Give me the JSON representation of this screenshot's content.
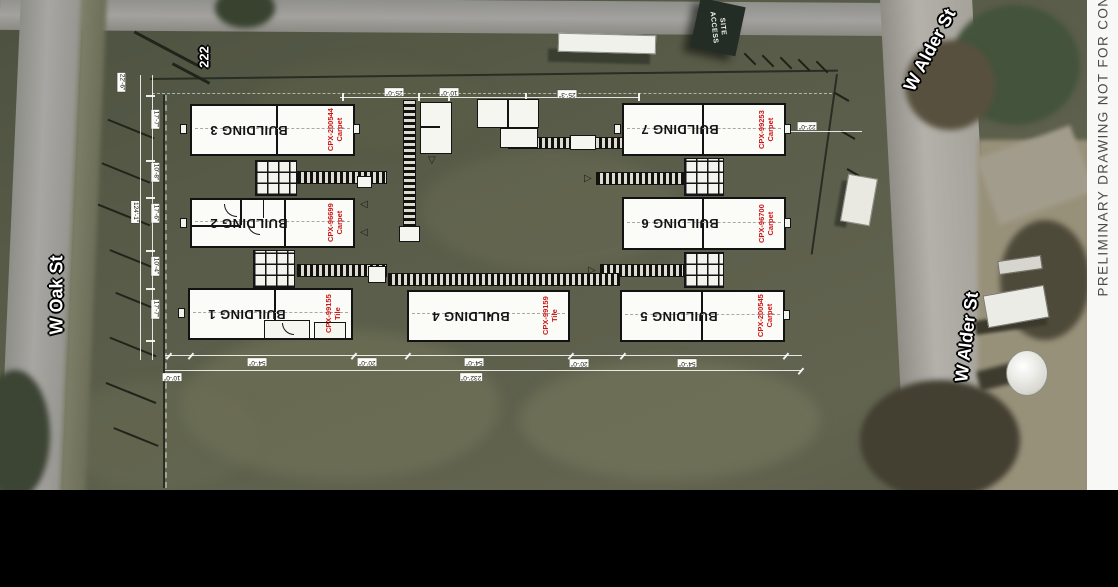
{
  "strip": {
    "text": "PRELIMINARY DRAWING NOT FOR CON"
  },
  "overlay": {
    "site_access_line1": "SITE",
    "site_access_line2": "ACCESS",
    "marker_222": "222"
  },
  "streets": {
    "oak": "W Oak St",
    "alder_upper": "W Alder St",
    "alder_lower": "W Alder St"
  },
  "buildings": [
    {
      "id": "building-3",
      "name": "BUILDING 3",
      "code": "CPX-200544",
      "finish": "Carpet"
    },
    {
      "id": "building-2",
      "name": "BUILDING 2",
      "code": "CPX-96699",
      "finish": "Carpet"
    },
    {
      "id": "building-1",
      "name": "BUILDING 1",
      "code": "CPX-99155",
      "finish": "Tile"
    },
    {
      "id": "building-4",
      "name": "BUILDING 4",
      "code": "CPX-99159",
      "finish": "Tile"
    },
    {
      "id": "building-7",
      "name": "BUILDING 7",
      "code": "CPX-99253",
      "finish": "Carpet"
    },
    {
      "id": "building-6",
      "name": "BUILDING 6",
      "code": "CPX-96700",
      "finish": "Carpet"
    },
    {
      "id": "building-5",
      "name": "BUILDING 5",
      "code": "CPX-200545",
      "finish": "Carpet"
    }
  ],
  "dimensions": [
    {
      "text": "22'-6\"",
      "x": 112,
      "y": 78,
      "rot": 90
    },
    {
      "text": "17'-7\"",
      "x": 146,
      "y": 115,
      "rot": 90
    },
    {
      "text": "10'-8\"",
      "x": 146,
      "y": 168,
      "rot": 90
    },
    {
      "text": "17'-6\"",
      "x": 146,
      "y": 209,
      "rot": 90
    },
    {
      "text": "124'-1\"",
      "x": 124,
      "y": 208,
      "rot": 90
    },
    {
      "text": "10'-4\"",
      "x": 146,
      "y": 262,
      "rot": 90
    },
    {
      "text": "17'-7\"",
      "x": 146,
      "y": 305,
      "rot": 90
    },
    {
      "text": "25'-0\"",
      "x": 385,
      "y": 88,
      "rot": 180
    },
    {
      "text": "10'-0\"",
      "x": 440,
      "y": 88,
      "rot": 180
    },
    {
      "text": "25'-3\"",
      "x": 558,
      "y": 90,
      "rot": 180
    },
    {
      "text": "22'-0\"",
      "x": 798,
      "y": 122,
      "rot": 180
    },
    {
      "text": "10'-0\"",
      "x": 163,
      "y": 373,
      "rot": 180
    },
    {
      "text": "54'-0\"",
      "x": 248,
      "y": 358,
      "rot": 180
    },
    {
      "text": "20'-0\"",
      "x": 358,
      "y": 358,
      "rot": 180
    },
    {
      "text": "54'-0\"",
      "x": 465,
      "y": 358,
      "rot": 180
    },
    {
      "text": "20'-0\"",
      "x": 570,
      "y": 359,
      "rot": 180
    },
    {
      "text": "54'-0\"",
      "x": 678,
      "y": 359,
      "rot": 180
    },
    {
      "text": "232'-0\"",
      "x": 460,
      "y": 373,
      "rot": 180
    }
  ],
  "colors": {
    "finish_label_red": "#cc1414",
    "building_fill": "#fbfbf8",
    "drawing_line_black": "#121212",
    "field_green": "#565a46",
    "road_grey": "#a09f9b",
    "strip_white": "#f8f8f6"
  }
}
